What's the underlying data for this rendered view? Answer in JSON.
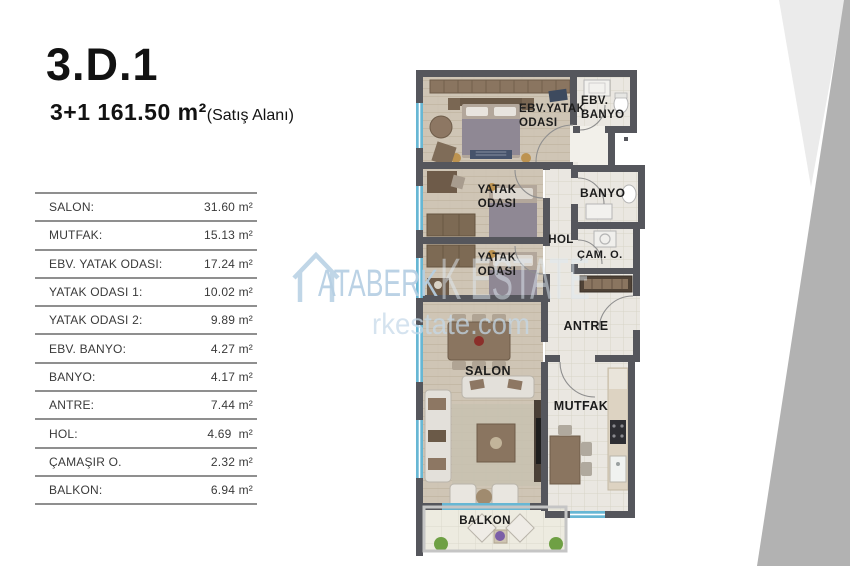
{
  "header": {
    "title": "3.D.1",
    "area": "3+1 161.50 m²",
    "area_note": "(Satış Alanı)"
  },
  "table": {
    "rows": [
      {
        "label": "SALON:",
        "value": "31.60 m²"
      },
      {
        "label": "MUTFAK:",
        "value": "15.13 m²"
      },
      {
        "label": "EBV. YATAK ODASI:",
        "value": "17.24 m²"
      },
      {
        "label": "YATAK ODASI 1:",
        "value": "10.02 m²"
      },
      {
        "label": "YATAK ODASI 2:",
        "value": "9.89 m²"
      },
      {
        "label": "EBV. BANYO:",
        "value": "4.27 m²"
      },
      {
        "label": "BANYO:",
        "value": "4.17 m²"
      },
      {
        "label": "ANTRE:",
        "value": "7.44 m²"
      },
      {
        "label": "HOL:",
        "value": "4.69  m²"
      },
      {
        "label": "ÇAMAŞIR O.",
        "value": "2.32 m²"
      },
      {
        "label": "BALKON:",
        "value": "6.94 m²"
      }
    ]
  },
  "plan": {
    "labels": {
      "ebv_yatak_1": "EBV.YATAK",
      "ebv_yatak_2": "ODASI",
      "ebv_banyo_1": "EBV.",
      "ebv_banyo_2": "BANYO",
      "yatak1_1": "YATAK",
      "yatak1_2": "ODASI",
      "yatak2_1": "YATAK",
      "yatak2_2": "ODASI",
      "banyo": "BANYO",
      "hol": "HOL",
      "cam_o": "ÇAM. O.",
      "antre": "ANTRE",
      "salon": "SALON",
      "mutfak": "MUTFAK",
      "balkon": "BALKON"
    }
  },
  "watermark": {
    "brand_small": "ATABERK",
    "brand_fragment_large": "K ESTATE",
    "domain_fragment": "rkestate.com"
  },
  "colors": {
    "wall": "#55565c",
    "wood_floor": "#cfc5b5",
    "tile_floor": "#eae7e1",
    "window": "#67b7d4",
    "watermark_blue": "#b6cfe3",
    "triangle_light": "#ebebeb",
    "triangle_dark": "#b2b2b2"
  }
}
